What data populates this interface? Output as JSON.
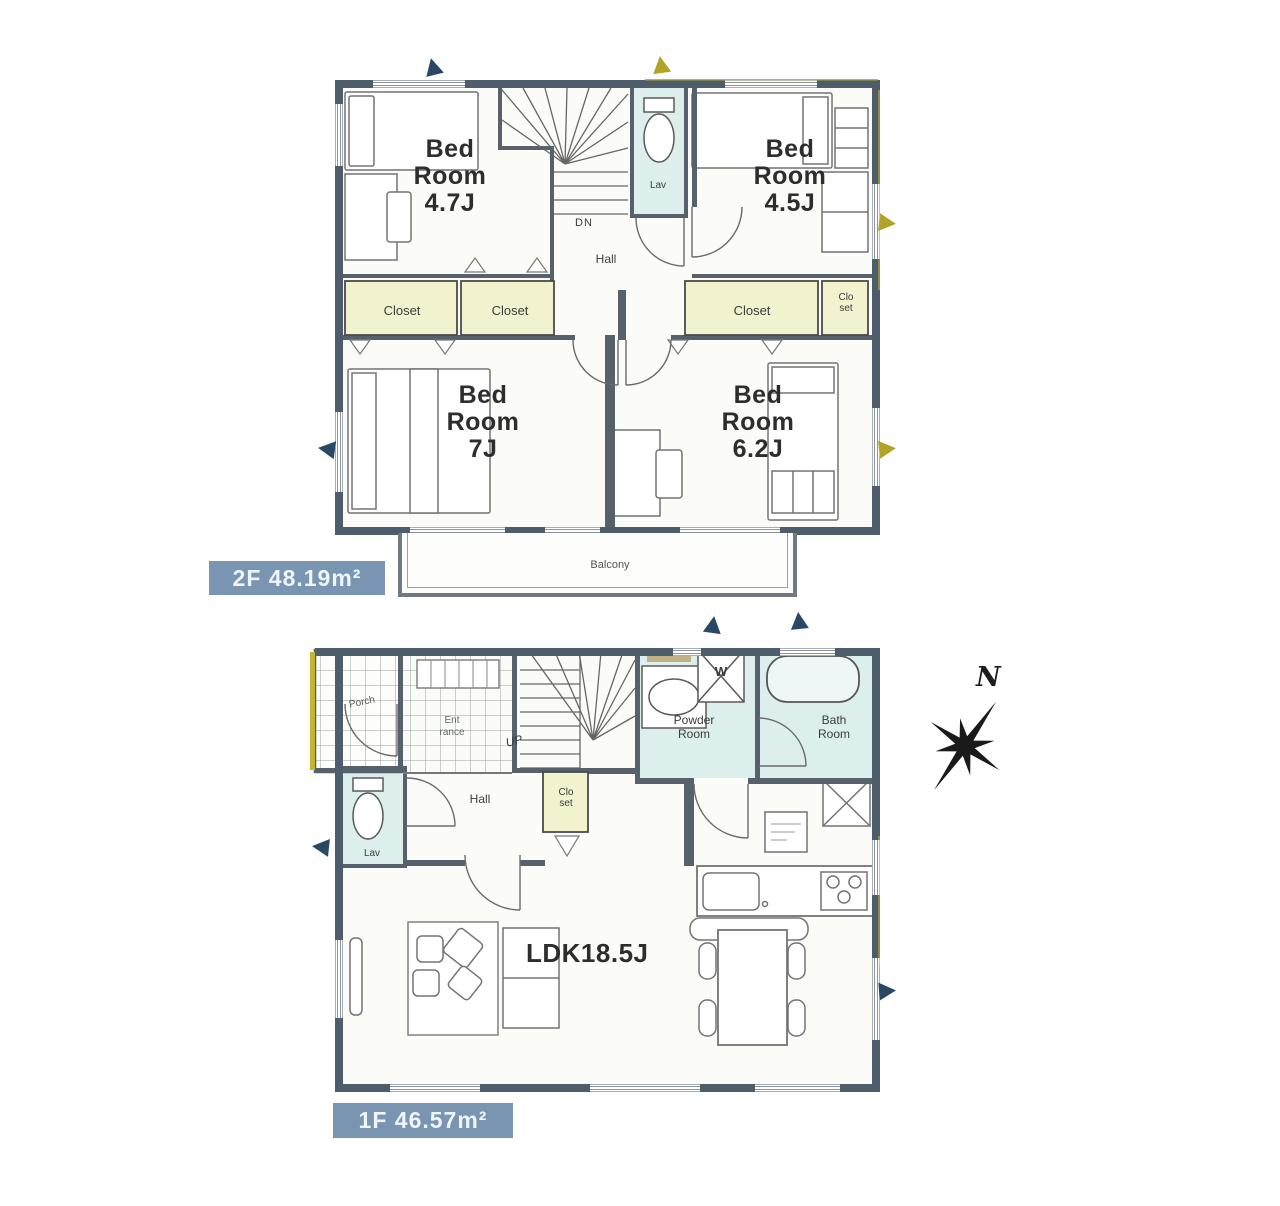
{
  "compass": {
    "north": "N"
  },
  "floor2": {
    "area_label": "2F 48.19m²",
    "bedroom_nw": [
      "Bed",
      "Room",
      "4.7J"
    ],
    "bedroom_ne": [
      "Bed",
      "Room",
      "4.5J"
    ],
    "bedroom_sw": [
      "Bed",
      "Room",
      "7J"
    ],
    "bedroom_se": [
      "Bed",
      "Room",
      "6.2J"
    ],
    "hall": "Hall",
    "stairs_down": "DN",
    "lavatory": "Lav",
    "closets": [
      "Closet",
      "Closet",
      "Closet"
    ],
    "closet_small": [
      "Clo",
      "set"
    ],
    "balcony": "Balcony"
  },
  "floor1": {
    "area_label": "1F 46.57m²",
    "porch": "Porch",
    "entrance": [
      "Ent",
      "rance"
    ],
    "stairs_up": "UP",
    "powder_room": [
      "Powder",
      "Room"
    ],
    "bath_room": [
      "Bath",
      "Room"
    ],
    "washer": "W",
    "lavatory": "Lav",
    "hall": "Hall",
    "closet_small": [
      "Clo",
      "set"
    ],
    "ldk": "LDK18.5J"
  },
  "colors": {
    "wall": "#4d5d6c",
    "water_room_fill": "#dcefec",
    "closet_fill": "#f2f2cf",
    "area_chip_bg": "#7995b2",
    "arrow_navy": "#2a4763",
    "arrow_yellow": "#b1a325"
  }
}
